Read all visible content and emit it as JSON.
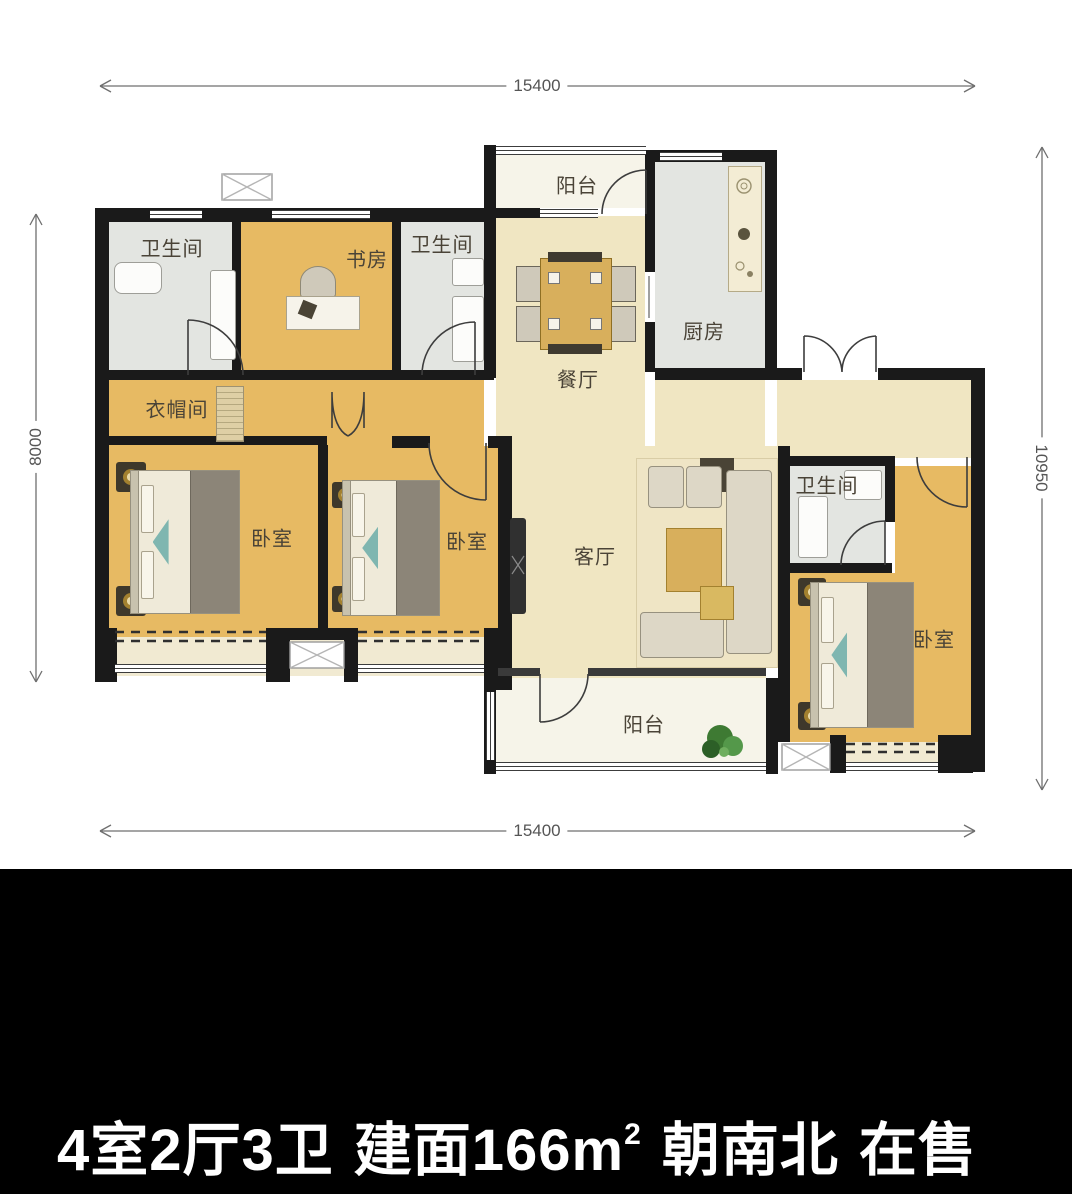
{
  "plan": {
    "rooms": [
      {
        "id": "bath-top-left",
        "label": "卫生间"
      },
      {
        "id": "study",
        "label": "书房"
      },
      {
        "id": "bath-middle",
        "label": "卫生间"
      },
      {
        "id": "balcony-top",
        "label": "阳台"
      },
      {
        "id": "kitchen",
        "label": "厨房"
      },
      {
        "id": "dining-room",
        "label": "餐厅"
      },
      {
        "id": "cloakroom",
        "label": "衣帽间"
      },
      {
        "id": "bedroom-left",
        "label": "卧室"
      },
      {
        "id": "bedroom-middle",
        "label": "卧室"
      },
      {
        "id": "living-room",
        "label": "客厅"
      },
      {
        "id": "bath-right",
        "label": "卫生间"
      },
      {
        "id": "bedroom-right",
        "label": "卧室"
      },
      {
        "id": "balcony-bottom",
        "label": "阳台"
      }
    ],
    "dimensions": {
      "top": "15400",
      "bottom": "15400",
      "left": "8000",
      "right": "10950"
    }
  },
  "caption": {
    "full": "4室2厅3卫 建面166m² 朝南北 在售",
    "layout": "4室2厅3卫",
    "area_prefix": "建面166m",
    "area_sup": "2",
    "orientation": "朝南北",
    "status": "在售"
  },
  "colors": {
    "floor_wood": "#E7BA63",
    "floor_cream": "#F0E6C2",
    "floor_gray": "#E3E5E1",
    "floor_pale": "#F6F4E9",
    "floor_bay": "#F1EAD2",
    "wall": "#1A1A1A",
    "label_text": "#4A4337",
    "dim_text": "#555555",
    "caption_bg": "#000000",
    "caption_text": "#FFFFFF",
    "accent_gold": "#C29B2C",
    "furniture_wood": "#D8AF5C",
    "plant_green": "#3E7A33"
  }
}
